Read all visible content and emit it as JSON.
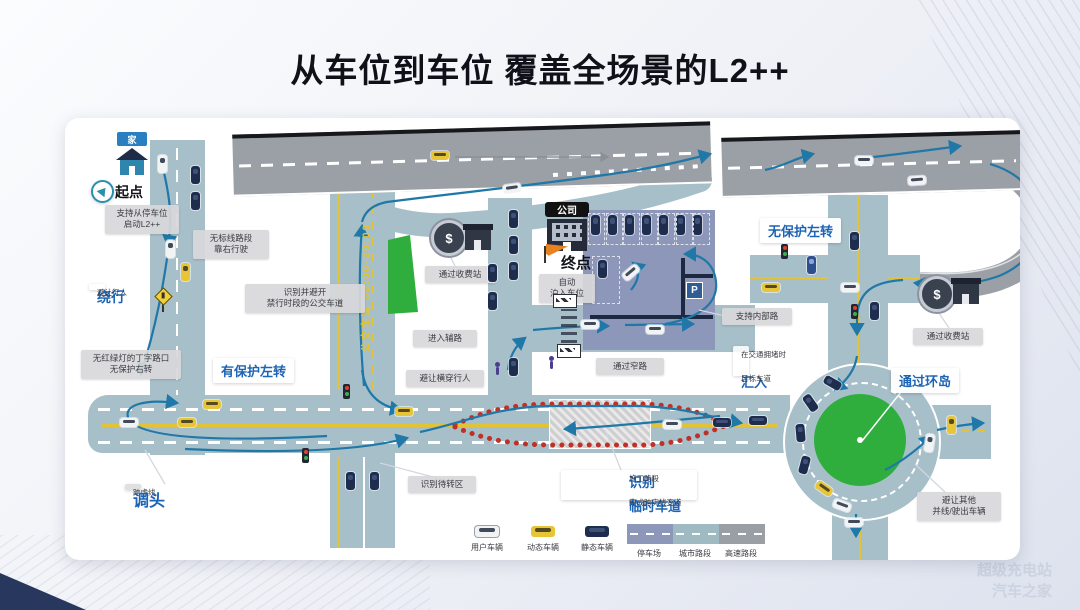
{
  "title": "从车位到车位  覆盖全场景的L2++",
  "watermark": {
    "line1": "超级充电站",
    "line2": "汽车之家"
  },
  "colors": {
    "accent_blue": "#1d64b4",
    "road_teal": "#a7bfc9",
    "highway_gray": "#9b9fa6",
    "parking_purple": "#8d97b9",
    "green": "#2fae3e",
    "lane_yellow": "#e2c335",
    "cone_red": "#c03026",
    "arrow_blue": "#1f78a8"
  },
  "map": {
    "home_sign": "家",
    "start": "起点",
    "start_note": "支持从停车位\n启动L2++",
    "no_marking_note": "无标线路段\n靠右行驶",
    "detour": {
      "big": "绕行",
      "small": "避让行人"
    },
    "t_junction_note": "无红绿灯的丁字路口\n无保护右转",
    "protected_left": "有保护左转",
    "bus_lane_note": "识别并避开\n禁行时段的公交车道",
    "bus_lane_text": "公交车道 06:00-20:00",
    "u_turn": {
      "small": "跨虚线",
      "big": "调头"
    },
    "toll_left": "通过收费站",
    "enter_side_road": "进入辅路",
    "avoid_crossing": "避让横穿行人",
    "waiting_zone": "识别待转区",
    "company": "公司",
    "end": "终点",
    "auto_park": "自动\n泊入车位",
    "narrow_road": "通过窄路",
    "internal_road": "支持内部路",
    "p_sign": "P",
    "dollar": "$",
    "construction": {
      "b1": "识别",
      "s1": "施工路段",
      "s2": "的",
      "b2": "临时车道",
      "s3": "完成跨实线变道"
    },
    "merge": {
      "s1": "在交通拥堵时",
      "big": "汇入",
      "s2": "目标车道"
    },
    "unprotected_left": "无保护左转",
    "toll_right": "通过收费站",
    "roundabout": "通过环岛",
    "avoid_merge": "避让其他\n并线/驶出车辆"
  },
  "legend": {
    "user": "用户车辆",
    "dynamic": "动态车辆",
    "static": "静态车辆",
    "parking": "停车场",
    "city": "城市路段",
    "highway": "高速路段"
  }
}
